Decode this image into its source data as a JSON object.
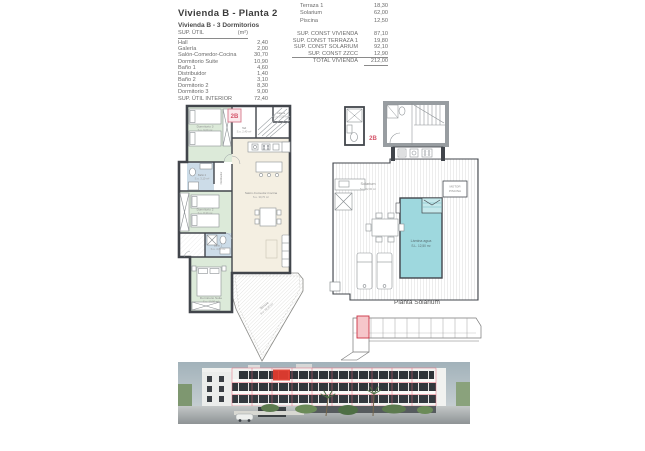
{
  "header": {
    "title": "Vivienda B - Planta 2",
    "subtitle": "Vivienda B - 3 Dormitorios"
  },
  "area_table": {
    "header_label": "SUP. ÚTIL",
    "header_unit": "(m²)",
    "rows": [
      {
        "label": "Hall",
        "value": "2,40"
      },
      {
        "label": "Galería",
        "value": "2,00"
      },
      {
        "label": "Salón-Comedor-Cocina",
        "value": "30,70"
      },
      {
        "label": "Dormitorio Suite",
        "value": "10,90"
      },
      {
        "label": "Baño 1",
        "value": "4,60"
      },
      {
        "label": "Distribuidor",
        "value": "1,40"
      },
      {
        "label": "Baño 2",
        "value": "3,10"
      },
      {
        "label": "Dormitorio 2",
        "value": "8,30"
      },
      {
        "label": "Dormitorio 3",
        "value": "9,00"
      }
    ],
    "total": {
      "label": "SUP. ÚTIL INTERIOR",
      "value": "72,40"
    }
  },
  "exterior_table": {
    "rows": [
      {
        "label": "Terraza 1",
        "value": "18,30"
      },
      {
        "label": "Solarium",
        "value": "62,00"
      },
      {
        "label": "Piscina",
        "value": "12,50"
      }
    ]
  },
  "const_table": {
    "rows": [
      {
        "label": "SUP. CONST VIVIENDA",
        "value": "87,10"
      },
      {
        "label": "SUP. CONST TERRAZA 1",
        "value": "19,80"
      },
      {
        "label": "SUP. CONST SOLARIUM",
        "value": "92,10"
      },
      {
        "label": "SUP. CONST ZZCC",
        "value": "12,90"
      }
    ],
    "total": {
      "label": "TOTAL VIVIENDA",
      "value": "212,00"
    }
  },
  "plan_main": {
    "unit_badge": "2B",
    "labels": {
      "hall": {
        "name": "Hall",
        "area": "S.u. 2,40 m²"
      },
      "galeria": {
        "name": "Galería",
        "area": "S.u. 2,00 m²"
      },
      "salon": {
        "name": "Salón-Comedor-Cocina",
        "area": "S.u. 30,70 m²"
      },
      "dorm3": {
        "name": "Dormitorio 3",
        "area": "S.u. 9,00 m²"
      },
      "dorm2": {
        "name": "Dormitorio 2",
        "area": "S.u. 8,30 m²"
      },
      "suite": {
        "name": "Dormitorio Suite",
        "area": "S.u. 10,90 m²"
      },
      "bano1": {
        "name": "Baño 1",
        "area": "S.u. 4,60 m²"
      },
      "bano2": {
        "name": "Baño 2",
        "area": "S.u. 3,10 m²"
      },
      "distribuidor": {
        "name": "Distribuidor"
      },
      "terraza": {
        "name": "Terraza",
        "area": "S.u. 18,30 m²"
      }
    }
  },
  "plan_solarium": {
    "unit_badge": "2B",
    "caption": "Planta Solarium",
    "labels": {
      "solarium": {
        "name": "Solarium",
        "area": "S.u. 62,00 m²"
      },
      "pool": {
        "name": "Lámina agua",
        "area": "S.L. 12,50 m²"
      },
      "motor": {
        "line1": "MOTOR",
        "line2": "PISCINA"
      }
    }
  },
  "colors": {
    "accent_red": "#d4556a",
    "wall": "#41454b",
    "room_green": "#dcead9",
    "room_blue": "#ccdce8",
    "room_cream": "#f4efe2",
    "pool_water": "#9ed8de",
    "photo_highlight": "#e23b2e"
  }
}
